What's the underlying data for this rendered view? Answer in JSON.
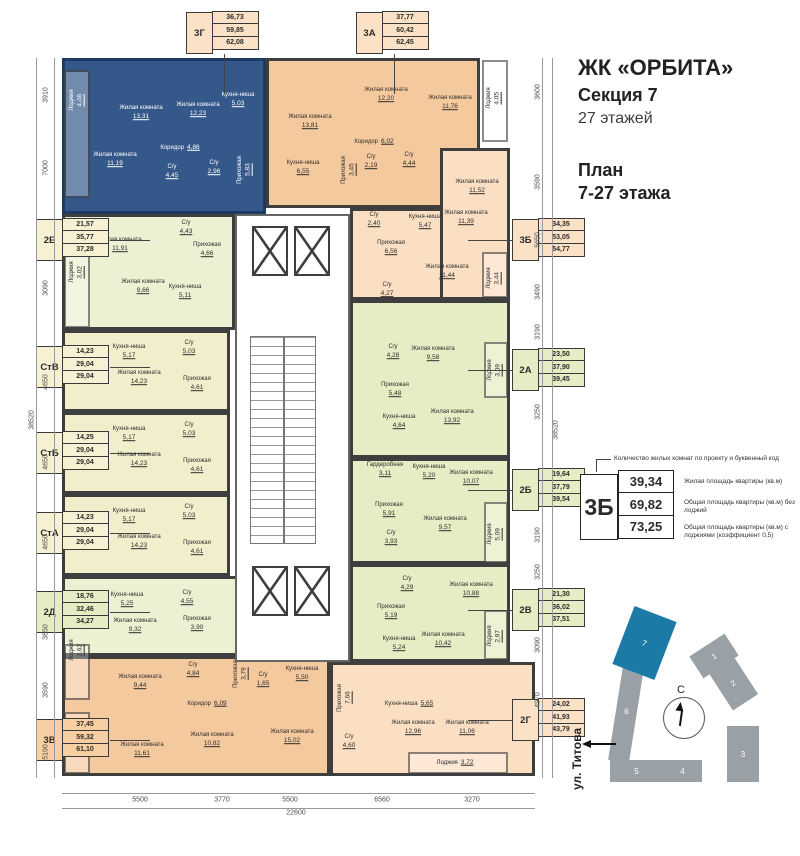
{
  "header": {
    "complex": "ЖК «ОРБИТА»",
    "section": "Секция 7",
    "floors": "27 этажей",
    "plan_line1": "План",
    "plan_line2": "7-27 этажа"
  },
  "legend": {
    "callout": "Количество жилых комнат по проекту и буквенный код",
    "sample_code": "3Б",
    "rows": [
      {
        "value": "39,34",
        "label": "Жилая площадь квартиры (кв.м)"
      },
      {
        "value": "69,82",
        "label": "Общая площадь квартиры (кв.м) без лоджий"
      },
      {
        "value": "73,25",
        "label": "Общая площадь квартиры (кв.м) с лоджиями (коэффициент 0,5)"
      }
    ]
  },
  "minimap": {
    "north": "С",
    "street": "ул. Титова",
    "highlighted": "7",
    "buildings": [
      "1",
      "2",
      "3",
      "4",
      "5",
      "6",
      "7"
    ]
  },
  "plan": {
    "unit_labels": [
      {
        "code": "3Г",
        "cls": "lpeach",
        "x": 186,
        "y": 12,
        "side": "top",
        "values": [
          "36,73",
          "59,85",
          "62,08"
        ]
      },
      {
        "code": "3А",
        "cls": "lpeach",
        "x": 356,
        "y": 12,
        "side": "top",
        "values": [
          "37,77",
          "60,42",
          "62,45"
        ]
      },
      {
        "code": "2Е",
        "cls": "lcream",
        "x": 36,
        "y": 219,
        "side": "left",
        "values": [
          "21,57",
          "35,77",
          "37,28"
        ]
      },
      {
        "code": "СтВ",
        "cls": "lcream",
        "x": 36,
        "y": 346,
        "side": "left",
        "values": [
          "14,23",
          "29,04",
          "29,04"
        ]
      },
      {
        "code": "СтБ",
        "cls": "lcream",
        "x": 36,
        "y": 432,
        "side": "left",
        "values": [
          "14,25",
          "29,04",
          "29,04"
        ]
      },
      {
        "code": "СтА",
        "cls": "lcream",
        "x": 36,
        "y": 512,
        "side": "left",
        "values": [
          "14,23",
          "29,04",
          "29,04"
        ]
      },
      {
        "code": "2Д",
        "cls": "lgreen",
        "x": 36,
        "y": 591,
        "side": "left",
        "values": [
          "18,76",
          "32,46",
          "34,27"
        ]
      },
      {
        "code": "3В",
        "cls": "lorange",
        "x": 36,
        "y": 719,
        "side": "left",
        "values": [
          "37,45",
          "59,32",
          "61,10"
        ]
      },
      {
        "code": "3Б",
        "cls": "lpeach",
        "x": 512,
        "y": 219,
        "side": "right",
        "values": [
          "34,35",
          "53,05",
          "54,77"
        ]
      },
      {
        "code": "2А",
        "cls": "lgreen",
        "x": 512,
        "y": 349,
        "side": "right",
        "values": [
          "23,50",
          "37,90",
          "39,45"
        ]
      },
      {
        "code": "2Б",
        "cls": "lgreen",
        "x": 512,
        "y": 469,
        "side": "right",
        "values": [
          "19,64",
          "37,79",
          "39,54"
        ]
      },
      {
        "code": "2В",
        "cls": "lgreen",
        "x": 512,
        "y": 589,
        "side": "right",
        "values": [
          "21,30",
          "36,02",
          "37,51"
        ]
      },
      {
        "code": "2Г",
        "cls": "lpeach",
        "x": 512,
        "y": 699,
        "side": "right",
        "values": [
          "24,02",
          "41,93",
          "43,79"
        ]
      }
    ],
    "rooms": [
      {
        "n": "Жилая комната",
        "a": "13,31",
        "x": 141,
        "y": 113,
        "w": 1
      },
      {
        "n": "Жилая комната",
        "a": "12,23",
        "x": 198,
        "y": 110,
        "w": 1
      },
      {
        "n": "Кухня-ниша",
        "a": "5,03",
        "x": 238,
        "y": 100,
        "w": 1
      },
      {
        "n": "Коридор",
        "a": "4,86",
        "x": 180,
        "y": 148,
        "w": 1,
        "i": 1
      },
      {
        "n": "Жилая комната",
        "a": "11,19",
        "x": 115,
        "y": 160,
        "w": 1
      },
      {
        "n": "С/у",
        "a": "4,45",
        "x": 172,
        "y": 172,
        "w": 1
      },
      {
        "n": "С/у",
        "a": "2,96",
        "x": 214,
        "y": 168,
        "w": 1
      },
      {
        "n": "Прихожая",
        "a": "5,83",
        "x": 245,
        "y": 170,
        "w": 1,
        "v": 1
      },
      {
        "n": "Лоджия",
        "a": "4,46",
        "x": 77,
        "y": 100,
        "w": 1,
        "v": 1
      },
      {
        "n": "Жилая комната",
        "a": "13,81",
        "x": 310,
        "y": 122
      },
      {
        "n": "Кухня-ниша",
        "a": "6,55",
        "x": 303,
        "y": 168
      },
      {
        "n": "Прихожая",
        "a": "3,45",
        "x": 349,
        "y": 170,
        "v": 1
      },
      {
        "n": "С/у",
        "a": "2,19",
        "x": 371,
        "y": 162
      },
      {
        "n": "С/у",
        "a": "4,44",
        "x": 409,
        "y": 160
      },
      {
        "n": "Коридор",
        "a": "6,02",
        "x": 374,
        "y": 142,
        "i": 1
      },
      {
        "n": "Жилая комната",
        "a": "12,20",
        "x": 386,
        "y": 95
      },
      {
        "n": "Жилая комната",
        "a": "11,76",
        "x": 450,
        "y": 103
      },
      {
        "n": "Лоджия",
        "a": "4,05",
        "x": 494,
        "y": 98,
        "v": 1
      },
      {
        "n": "Жилая комната",
        "a": "11,52",
        "x": 477,
        "y": 187
      },
      {
        "n": "С/у",
        "a": "2,40",
        "x": 374,
        "y": 220
      },
      {
        "n": "Кухня-ниша",
        "a": "5,47",
        "x": 425,
        "y": 222
      },
      {
        "n": "Жилая комната",
        "a": "11,39",
        "x": 466,
        "y": 218
      },
      {
        "n": "Прихожая",
        "a": "6,56",
        "x": 391,
        "y": 248
      },
      {
        "n": "Жилая комната",
        "a": "11,44",
        "x": 447,
        "y": 272
      },
      {
        "n": "С/у",
        "a": "4,27",
        "x": 387,
        "y": 290
      },
      {
        "n": "Лоджия",
        "a": "3,44",
        "x": 494,
        "y": 278,
        "v": 1
      },
      {
        "n": "Жилая комната",
        "a": "11,91",
        "x": 120,
        "y": 245
      },
      {
        "n": "С/у",
        "a": "4,43",
        "x": 186,
        "y": 228
      },
      {
        "n": "Прихожая",
        "a": "4,66",
        "x": 207,
        "y": 250
      },
      {
        "n": "Жилая комната",
        "a": "9,66",
        "x": 143,
        "y": 287
      },
      {
        "n": "Кухня-ниша",
        "a": "5,11",
        "x": 185,
        "y": 292
      },
      {
        "n": "Лоджия",
        "a": "3,02",
        "x": 77,
        "y": 272,
        "v": 1
      },
      {
        "n": "Кухня-ниша",
        "a": "5,17",
        "x": 129,
        "y": 352
      },
      {
        "n": "С/у",
        "a": "5,03",
        "x": 189,
        "y": 348
      },
      {
        "n": "Жилая комната",
        "a": "14,23",
        "x": 139,
        "y": 378
      },
      {
        "n": "Прихожая",
        "a": "4,61",
        "x": 197,
        "y": 384
      },
      {
        "n": "Кухня-ниша",
        "a": "5,17",
        "x": 129,
        "y": 434
      },
      {
        "n": "С/у",
        "a": "5,03",
        "x": 189,
        "y": 430
      },
      {
        "n": "Жилая комната",
        "a": "14,23",
        "x": 139,
        "y": 460
      },
      {
        "n": "Прихожая",
        "a": "4,61",
        "x": 197,
        "y": 466
      },
      {
        "n": "Кухня-ниша",
        "a": "5,17",
        "x": 129,
        "y": 516
      },
      {
        "n": "С/у",
        "a": "5,03",
        "x": 189,
        "y": 512
      },
      {
        "n": "Жилая комната",
        "a": "14,23",
        "x": 139,
        "y": 542
      },
      {
        "n": "Прихожая",
        "a": "4,61",
        "x": 197,
        "y": 548
      },
      {
        "n": "Кухня-ниша",
        "a": "5,25",
        "x": 127,
        "y": 600
      },
      {
        "n": "С/у",
        "a": "4,55",
        "x": 187,
        "y": 598
      },
      {
        "n": "Жилая комната",
        "a": "9,32",
        "x": 135,
        "y": 626
      },
      {
        "n": "Прихожая",
        "a": "3,90",
        "x": 197,
        "y": 624
      },
      {
        "n": "Жилая комната",
        "a": "9,44",
        "x": 140,
        "y": 682
      },
      {
        "n": "Лоджия",
        "a": "3,62",
        "x": 77,
        "y": 650,
        "v": 1
      },
      {
        "n": "Лоджия",
        "a": "3,55",
        "x": 77,
        "y": 742,
        "v": 1
      },
      {
        "n": "Жилая комната",
        "a": "11,61",
        "x": 142,
        "y": 750
      },
      {
        "n": "С/у",
        "a": "4,84",
        "x": 193,
        "y": 670
      },
      {
        "n": "С/у",
        "a": "1,65",
        "x": 263,
        "y": 680
      },
      {
        "n": "Прихожая",
        "a": "3,79",
        "x": 241,
        "y": 674,
        "v": 1
      },
      {
        "n": "Коридор",
        "a": "6,09",
        "x": 207,
        "y": 704,
        "i": 1
      },
      {
        "n": "Жилая комната",
        "a": "10,82",
        "x": 212,
        "y": 740
      },
      {
        "n": "Жилая комната",
        "a": "15,02",
        "x": 292,
        "y": 737
      },
      {
        "n": "Кухня-ниша",
        "a": "5,50",
        "x": 302,
        "y": 674
      },
      {
        "n": "С/у",
        "a": "4,28",
        "x": 393,
        "y": 352
      },
      {
        "n": "Жилая комната",
        "a": "9,58",
        "x": 433,
        "y": 354
      },
      {
        "n": "Лоджия",
        "a": "3,09",
        "x": 495,
        "y": 370,
        "v": 1
      },
      {
        "n": "Прихожая",
        "a": "5,48",
        "x": 395,
        "y": 390
      },
      {
        "n": "Кухня-ниша",
        "a": "4,64",
        "x": 399,
        "y": 422
      },
      {
        "n": "Жилая комната",
        "a": "13,92",
        "x": 452,
        "y": 417
      },
      {
        "n": "Гардеробная",
        "a": "3,11",
        "x": 385,
        "y": 470
      },
      {
        "n": "Кухня-ниша",
        "a": "5,20",
        "x": 429,
        "y": 472
      },
      {
        "n": "Жилая комната",
        "a": "10,07",
        "x": 471,
        "y": 478
      },
      {
        "n": "Прихожая",
        "a": "5,91",
        "x": 389,
        "y": 510
      },
      {
        "n": "Жилая комната",
        "a": "9,57",
        "x": 445,
        "y": 524
      },
      {
        "n": "С/у",
        "a": "3,93",
        "x": 391,
        "y": 538
      },
      {
        "n": "Лоджия",
        "a": "5,09",
        "x": 495,
        "y": 534,
        "v": 1
      },
      {
        "n": "С/у",
        "a": "4,29",
        "x": 407,
        "y": 584
      },
      {
        "n": "Жилая комната",
        "a": "10,88",
        "x": 471,
        "y": 590
      },
      {
        "n": "Прихожая",
        "a": "5,19",
        "x": 391,
        "y": 612
      },
      {
        "n": "Кухня-ниша",
        "a": "5,24",
        "x": 399,
        "y": 644
      },
      {
        "n": "Жилая комната",
        "a": "10,42",
        "x": 443,
        "y": 640
      },
      {
        "n": "Лоджия",
        "a": "2,97",
        "x": 495,
        "y": 636,
        "v": 1
      },
      {
        "n": "Прихожая",
        "a": "7,66",
        "x": 345,
        "y": 698,
        "v": 1
      },
      {
        "n": "Кухня-ниша",
        "a": "5,65",
        "x": 409,
        "y": 704,
        "i": 1
      },
      {
        "n": "Жилая комната",
        "a": "12,96",
        "x": 413,
        "y": 728
      },
      {
        "n": "Жилая комната",
        "a": "11,06",
        "x": 467,
        "y": 728
      },
      {
        "n": "С/у",
        "a": "4,60",
        "x": 349,
        "y": 742
      },
      {
        "n": "Лоджия",
        "a": "3,72",
        "x": 455,
        "y": 763,
        "i": 1
      }
    ],
    "dims": {
      "left": [
        [
          "3910",
          46,
          95
        ],
        [
          "7000",
          46,
          168
        ],
        [
          "3090",
          46,
          288
        ],
        [
          "4650",
          46,
          382
        ],
        [
          "4650",
          46,
          462
        ],
        [
          "4650",
          46,
          542
        ],
        [
          "3850",
          46,
          632
        ],
        [
          "3590",
          46,
          690
        ],
        [
          "5190",
          46,
          752
        ]
      ],
      "right": [
        [
          "3600",
          538,
          92
        ],
        [
          "3590",
          538,
          182
        ],
        [
          "5650",
          538,
          240
        ],
        [
          "3490",
          538,
          292
        ],
        [
          "3190",
          538,
          332
        ],
        [
          "3250",
          538,
          412
        ],
        [
          "3190",
          538,
          535
        ],
        [
          "3250",
          538,
          572
        ],
        [
          "3090",
          538,
          645
        ],
        [
          "4970",
          538,
          700
        ]
      ],
      "bottom": [
        [
          "5500",
          140,
          800
        ],
        [
          "3770",
          222,
          800
        ],
        [
          "5500",
          290,
          800
        ],
        [
          "6560",
          382,
          800
        ],
        [
          "3270",
          472,
          800
        ]
      ],
      "totals": [
        [
          "38520",
          32,
          420,
          "v"
        ],
        [
          "38520",
          556,
          430,
          "v"
        ],
        [
          "22600",
          296,
          813,
          "h"
        ]
      ]
    }
  }
}
